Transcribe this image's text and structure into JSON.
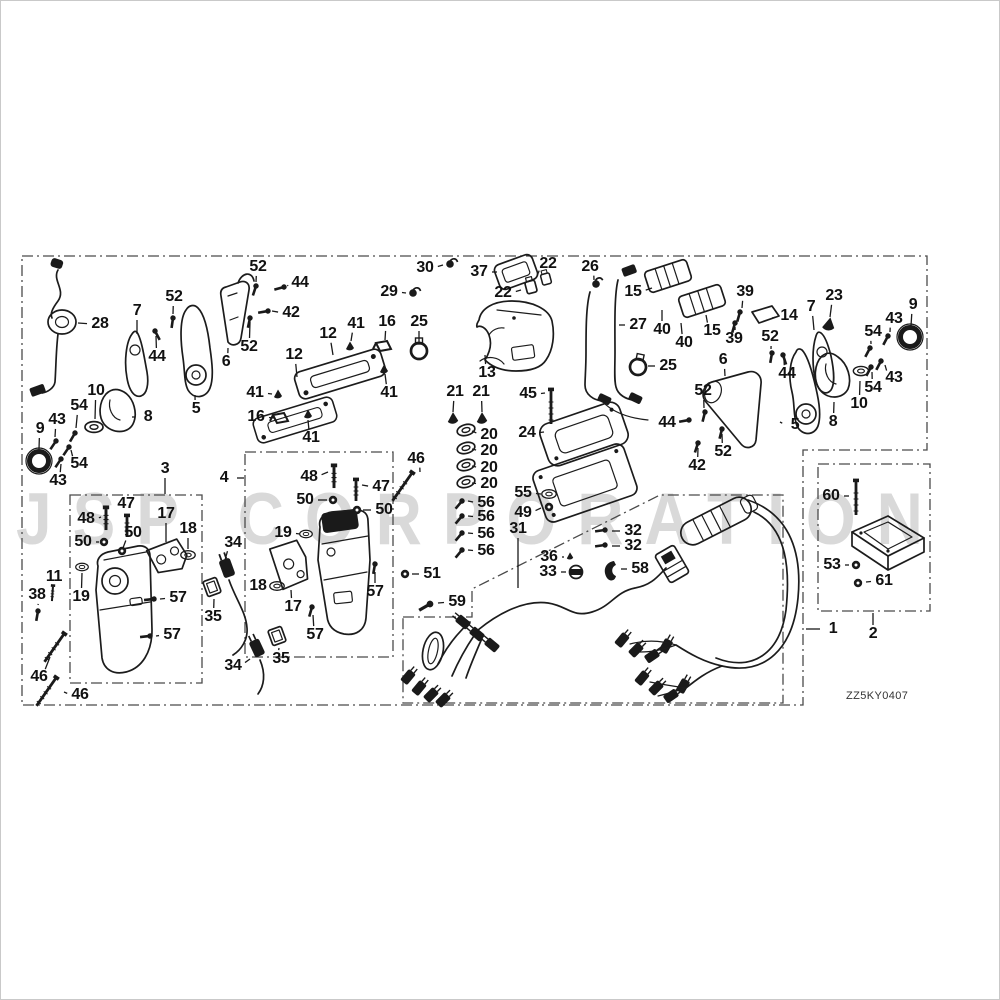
{
  "watermark": "JSP CORPORATION",
  "diagram_code": "ZZ5KY0407",
  "labels": [
    {
      "t": "28",
      "x": 100,
      "y": 324,
      "tx": 78,
      "ty": 323
    },
    {
      "t": "7",
      "x": 137,
      "y": 311,
      "tx": 137,
      "ty": 334
    },
    {
      "t": "52",
      "x": 174,
      "y": 297,
      "tx": 173,
      "ty": 314
    },
    {
      "t": "44",
      "x": 157,
      "y": 357,
      "tx": 156,
      "ty": 336
    },
    {
      "t": "52",
      "x": 258,
      "y": 267,
      "tx": 256,
      "ty": 282
    },
    {
      "t": "44",
      "x": 300,
      "y": 283,
      "tx": 288,
      "ty": 286
    },
    {
      "t": "42",
      "x": 291,
      "y": 313,
      "tx": 272,
      "ty": 311
    },
    {
      "t": "52",
      "x": 249,
      "y": 347,
      "tx": 250,
      "ty": 322
    },
    {
      "t": "6",
      "x": 226,
      "y": 362,
      "tx": 228,
      "ty": 348
    },
    {
      "t": "5",
      "x": 196,
      "y": 409,
      "tx": 195,
      "ty": 395
    },
    {
      "t": "10",
      "x": 96,
      "y": 391,
      "tx": 95,
      "ty": 419
    },
    {
      "t": "54",
      "x": 79,
      "y": 406,
      "tx": 76,
      "ty": 428
    },
    {
      "t": "43",
      "x": 57,
      "y": 420,
      "tx": 55,
      "ty": 437
    },
    {
      "t": "9",
      "x": 40,
      "y": 429,
      "tx": 39,
      "ty": 449
    },
    {
      "t": "54",
      "x": 79,
      "y": 464,
      "tx": 71,
      "ty": 450
    },
    {
      "t": "43",
      "x": 58,
      "y": 481,
      "tx": 61,
      "ty": 464
    },
    {
      "t": "8",
      "x": 148,
      "y": 417,
      "tx": 132,
      "ty": 417
    },
    {
      "t": "3",
      "x": 165,
      "y": 469,
      "tx": 165,
      "ty": 494
    },
    {
      "t": "4",
      "x": 224,
      "y": 478,
      "tx": 244,
      "ty": 478
    },
    {
      "t": "48",
      "x": 86,
      "y": 519,
      "tx": 101,
      "ty": 517
    },
    {
      "t": "47",
      "x": 126,
      "y": 504,
      "tx": 127,
      "ty": 513
    },
    {
      "t": "50",
      "x": 83,
      "y": 542,
      "tx": 99,
      "ty": 542
    },
    {
      "t": "50",
      "x": 133,
      "y": 533,
      "tx": 123,
      "ty": 548
    },
    {
      "t": "17",
      "x": 166,
      "y": 514,
      "tx": 166,
      "ty": 542
    },
    {
      "t": "18",
      "x": 188,
      "y": 529,
      "tx": 188,
      "ty": 549
    },
    {
      "t": "19",
      "x": 81,
      "y": 597,
      "tx": 82,
      "ty": 573
    },
    {
      "t": "57",
      "x": 178,
      "y": 598,
      "tx": 160,
      "ty": 599
    },
    {
      "t": "57",
      "x": 172,
      "y": 635,
      "tx": 156,
      "ty": 636
    },
    {
      "t": "11",
      "x": 54,
      "y": 577,
      "tx": 53,
      "ty": 586
    },
    {
      "t": "38",
      "x": 37,
      "y": 595,
      "tx": 38,
      "ty": 605
    },
    {
      "t": "46",
      "x": 39,
      "y": 677,
      "tx": 50,
      "ty": 657
    },
    {
      "t": "46",
      "x": 80,
      "y": 695,
      "tx": 64,
      "ty": 692
    },
    {
      "t": "41",
      "x": 311,
      "y": 438,
      "tx": 308,
      "ty": 420
    },
    {
      "t": "48",
      "x": 309,
      "y": 477,
      "tx": 328,
      "ty": 472
    },
    {
      "t": "47",
      "x": 381,
      "y": 487,
      "tx": 362,
      "ty": 485
    },
    {
      "t": "50",
      "x": 305,
      "y": 500,
      "tx": 327,
      "ty": 500
    },
    {
      "t": "50",
      "x": 384,
      "y": 510,
      "tx": 363,
      "ty": 510
    },
    {
      "t": "19",
      "x": 283,
      "y": 533,
      "tx": 300,
      "ty": 534
    },
    {
      "t": "18",
      "x": 258,
      "y": 586,
      "tx": 271,
      "ty": 586
    },
    {
      "t": "17",
      "x": 293,
      "y": 607,
      "tx": 291,
      "ty": 590
    },
    {
      "t": "57",
      "x": 375,
      "y": 592,
      "tx": 375,
      "ty": 572
    },
    {
      "t": "57",
      "x": 315,
      "y": 635,
      "tx": 313,
      "ty": 615
    },
    {
      "t": "34",
      "x": 233,
      "y": 543,
      "tx": 225,
      "ty": 560
    },
    {
      "t": "35",
      "x": 213,
      "y": 617,
      "tx": 214,
      "ty": 599
    },
    {
      "t": "34",
      "x": 233,
      "y": 666,
      "tx": 250,
      "ty": 659
    },
    {
      "t": "35",
      "x": 281,
      "y": 659,
      "tx": 279,
      "ty": 648
    },
    {
      "t": "51",
      "x": 432,
      "y": 574,
      "tx": 412,
      "ty": 574
    },
    {
      "t": "59",
      "x": 457,
      "y": 602,
      "tx": 438,
      "ty": 603
    },
    {
      "t": "46",
      "x": 416,
      "y": 459,
      "tx": 420,
      "ty": 472
    },
    {
      "t": "12",
      "x": 328,
      "y": 334,
      "tx": 333,
      "ty": 355
    },
    {
      "t": "12",
      "x": 294,
      "y": 355,
      "tx": 297,
      "ty": 377
    },
    {
      "t": "41",
      "x": 356,
      "y": 324,
      "tx": 351,
      "ty": 341
    },
    {
      "t": "41",
      "x": 255,
      "y": 393,
      "tx": 272,
      "ty": 394
    },
    {
      "t": "41",
      "x": 389,
      "y": 393,
      "tx": 385,
      "ty": 374
    },
    {
      "t": "16",
      "x": 387,
      "y": 322,
      "tx": 385,
      "ty": 340
    },
    {
      "t": "16",
      "x": 256,
      "y": 417,
      "tx": 274,
      "ty": 418
    },
    {
      "t": "25",
      "x": 419,
      "y": 322,
      "tx": 419,
      "ty": 342
    },
    {
      "t": "29",
      "x": 389,
      "y": 292,
      "tx": 406,
      "ty": 293
    },
    {
      "t": "30",
      "x": 425,
      "y": 268,
      "tx": 443,
      "ty": 265
    },
    {
      "t": "37",
      "x": 479,
      "y": 272,
      "tx": 497,
      "ty": 272
    },
    {
      "t": "22",
      "x": 548,
      "y": 264,
      "tx": 537,
      "ty": 276
    },
    {
      "t": "22",
      "x": 503,
      "y": 293,
      "tx": 521,
      "ty": 290
    },
    {
      "t": "13",
      "x": 487,
      "y": 373,
      "tx": 485,
      "ty": 355
    },
    {
      "t": "26",
      "x": 590,
      "y": 267,
      "tx": 594,
      "ty": 280
    },
    {
      "t": "27",
      "x": 638,
      "y": 325,
      "tx": 619,
      "ty": 325
    },
    {
      "t": "15",
      "x": 633,
      "y": 292,
      "tx": 652,
      "ty": 288
    },
    {
      "t": "40",
      "x": 662,
      "y": 330,
      "tx": 662,
      "ty": 310
    },
    {
      "t": "40",
      "x": 684,
      "y": 343,
      "tx": 681,
      "ty": 323
    },
    {
      "t": "15",
      "x": 712,
      "y": 331,
      "tx": 706,
      "ty": 315
    },
    {
      "t": "39",
      "x": 745,
      "y": 292,
      "tx": 742,
      "ty": 308
    },
    {
      "t": "39",
      "x": 734,
      "y": 339,
      "tx": 735,
      "ty": 327
    },
    {
      "t": "14",
      "x": 789,
      "y": 316,
      "tx": 772,
      "ty": 318
    },
    {
      "t": "25",
      "x": 668,
      "y": 366,
      "tx": 648,
      "ty": 366
    },
    {
      "t": "21",
      "x": 455,
      "y": 392,
      "tx": 453,
      "ty": 412
    },
    {
      "t": "21",
      "x": 481,
      "y": 392,
      "tx": 482,
      "ty": 412
    },
    {
      "t": "20",
      "x": 489,
      "y": 435,
      "tx": 472,
      "ty": 431
    },
    {
      "t": "20",
      "x": 489,
      "y": 451,
      "tx": 472,
      "ty": 449
    },
    {
      "t": "20",
      "x": 489,
      "y": 468,
      "tx": 472,
      "ty": 466
    },
    {
      "t": "20",
      "x": 489,
      "y": 484,
      "tx": 472,
      "ty": 483
    },
    {
      "t": "56",
      "x": 486,
      "y": 503,
      "tx": 468,
      "ty": 501
    },
    {
      "t": "56",
      "x": 486,
      "y": 517,
      "tx": 468,
      "ty": 516
    },
    {
      "t": "56",
      "x": 486,
      "y": 534,
      "tx": 468,
      "ty": 533
    },
    {
      "t": "56",
      "x": 486,
      "y": 551,
      "tx": 468,
      "ty": 550
    },
    {
      "t": "45",
      "x": 528,
      "y": 394,
      "tx": 545,
      "ty": 393
    },
    {
      "t": "24",
      "x": 527,
      "y": 433,
      "tx": 544,
      "ty": 432
    },
    {
      "t": "55",
      "x": 523,
      "y": 493,
      "tx": 541,
      "ty": 494
    },
    {
      "t": "49",
      "x": 523,
      "y": 513,
      "tx": 541,
      "ty": 508
    },
    {
      "t": "31",
      "x": 518,
      "y": 529,
      "tx": 518,
      "ty": 588
    },
    {
      "t": "32",
      "x": 633,
      "y": 531,
      "tx": 612,
      "ty": 531
    },
    {
      "t": "32",
      "x": 633,
      "y": 546,
      "tx": 612,
      "ty": 546
    },
    {
      "t": "36",
      "x": 549,
      "y": 557,
      "tx": 564,
      "ty": 557
    },
    {
      "t": "33",
      "x": 548,
      "y": 572,
      "tx": 566,
      "ty": 572
    },
    {
      "t": "58",
      "x": 640,
      "y": 569,
      "tx": 621,
      "ty": 569
    },
    {
      "t": "52",
      "x": 703,
      "y": 391,
      "tx": 704,
      "ty": 408
    },
    {
      "t": "6",
      "x": 723,
      "y": 360,
      "tx": 725,
      "ty": 376
    },
    {
      "t": "52",
      "x": 770,
      "y": 337,
      "tx": 771,
      "ty": 349
    },
    {
      "t": "44",
      "x": 787,
      "y": 374,
      "tx": 784,
      "ty": 360
    },
    {
      "t": "7",
      "x": 811,
      "y": 307,
      "tx": 814,
      "ty": 330
    },
    {
      "t": "23",
      "x": 834,
      "y": 296,
      "tx": 830,
      "ty": 317
    },
    {
      "t": "9",
      "x": 913,
      "y": 305,
      "tx": 911,
      "ty": 326
    },
    {
      "t": "43",
      "x": 894,
      "y": 319,
      "tx": 890,
      "ty": 332
    },
    {
      "t": "54",
      "x": 873,
      "y": 332,
      "tx": 871,
      "ty": 344
    },
    {
      "t": "43",
      "x": 894,
      "y": 378,
      "tx": 885,
      "ty": 365
    },
    {
      "t": "54",
      "x": 873,
      "y": 388,
      "tx": 872,
      "ty": 372
    },
    {
      "t": "10",
      "x": 859,
      "y": 404,
      "tx": 860,
      "ty": 381
    },
    {
      "t": "8",
      "x": 833,
      "y": 422,
      "tx": 834,
      "ty": 402
    },
    {
      "t": "5",
      "x": 795,
      "y": 425,
      "tx": 780,
      "ty": 422
    },
    {
      "t": "52",
      "x": 723,
      "y": 452,
      "tx": 722,
      "ty": 434
    },
    {
      "t": "42",
      "x": 697,
      "y": 466,
      "tx": 698,
      "ty": 448
    },
    {
      "t": "44",
      "x": 667,
      "y": 423,
      "tx": 685,
      "ty": 421
    },
    {
      "t": "60",
      "x": 831,
      "y": 496,
      "tx": 849,
      "ty": 496
    },
    {
      "t": "53",
      "x": 832,
      "y": 565,
      "tx": 849,
      "ty": 565
    },
    {
      "t": "61",
      "x": 884,
      "y": 581,
      "tx": 866,
      "ty": 582
    },
    {
      "t": "1",
      "x": 833,
      "y": 629,
      "tx": 806,
      "ty": 629
    },
    {
      "t": "2",
      "x": 873,
      "y": 634,
      "tx": 873,
      "ty": 613
    }
  ]
}
